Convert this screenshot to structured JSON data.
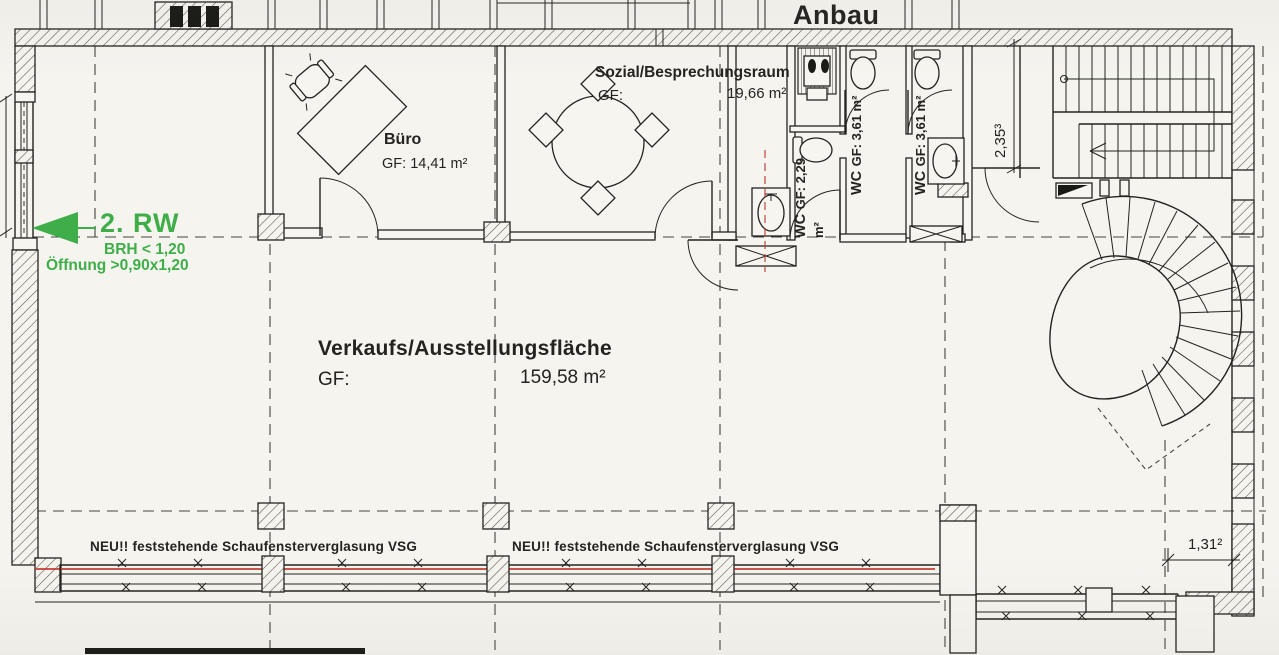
{
  "title": "Anbau",
  "main_area": {
    "name": "Verkaufs/Ausstellungsfläche",
    "gf_label": "GF:",
    "area_value": "159,58 m²"
  },
  "rooms": {
    "buero": {
      "name": "Büro",
      "area_line": "GF: 14,41 m²"
    },
    "sozial": {
      "name": "Sozial/Besprechungsraum",
      "gf_label": "GF:",
      "area_value": "19,66 m²"
    },
    "wc_left": {
      "name": "WC",
      "area_line": "GF: 2,29 m²"
    },
    "wc_mid": {
      "name": "WC",
      "area_line": "GF: 3,61 m²"
    },
    "wc_right": {
      "name": "WC",
      "area_line": "GF: 3,61 m²"
    }
  },
  "annotations": {
    "rescue_window": {
      "title": "2. RW",
      "line1": "BRH < 1,20",
      "line2": "Öffnung >0,90x1,20"
    },
    "glazing_note_left": "NEU!! feststehende Schaufensterverglasung VSG",
    "glazing_note_right": "NEU!! feststehende Schaufensterverglasung VSG"
  },
  "dimensions": {
    "stair_width": "2,35³",
    "right_offset": "1,31²"
  },
  "colors": {
    "annotation_green": "#3fae49",
    "marking_red": "#bf3a30",
    "ink": "#24231f",
    "paper": "#f5f4ef"
  }
}
